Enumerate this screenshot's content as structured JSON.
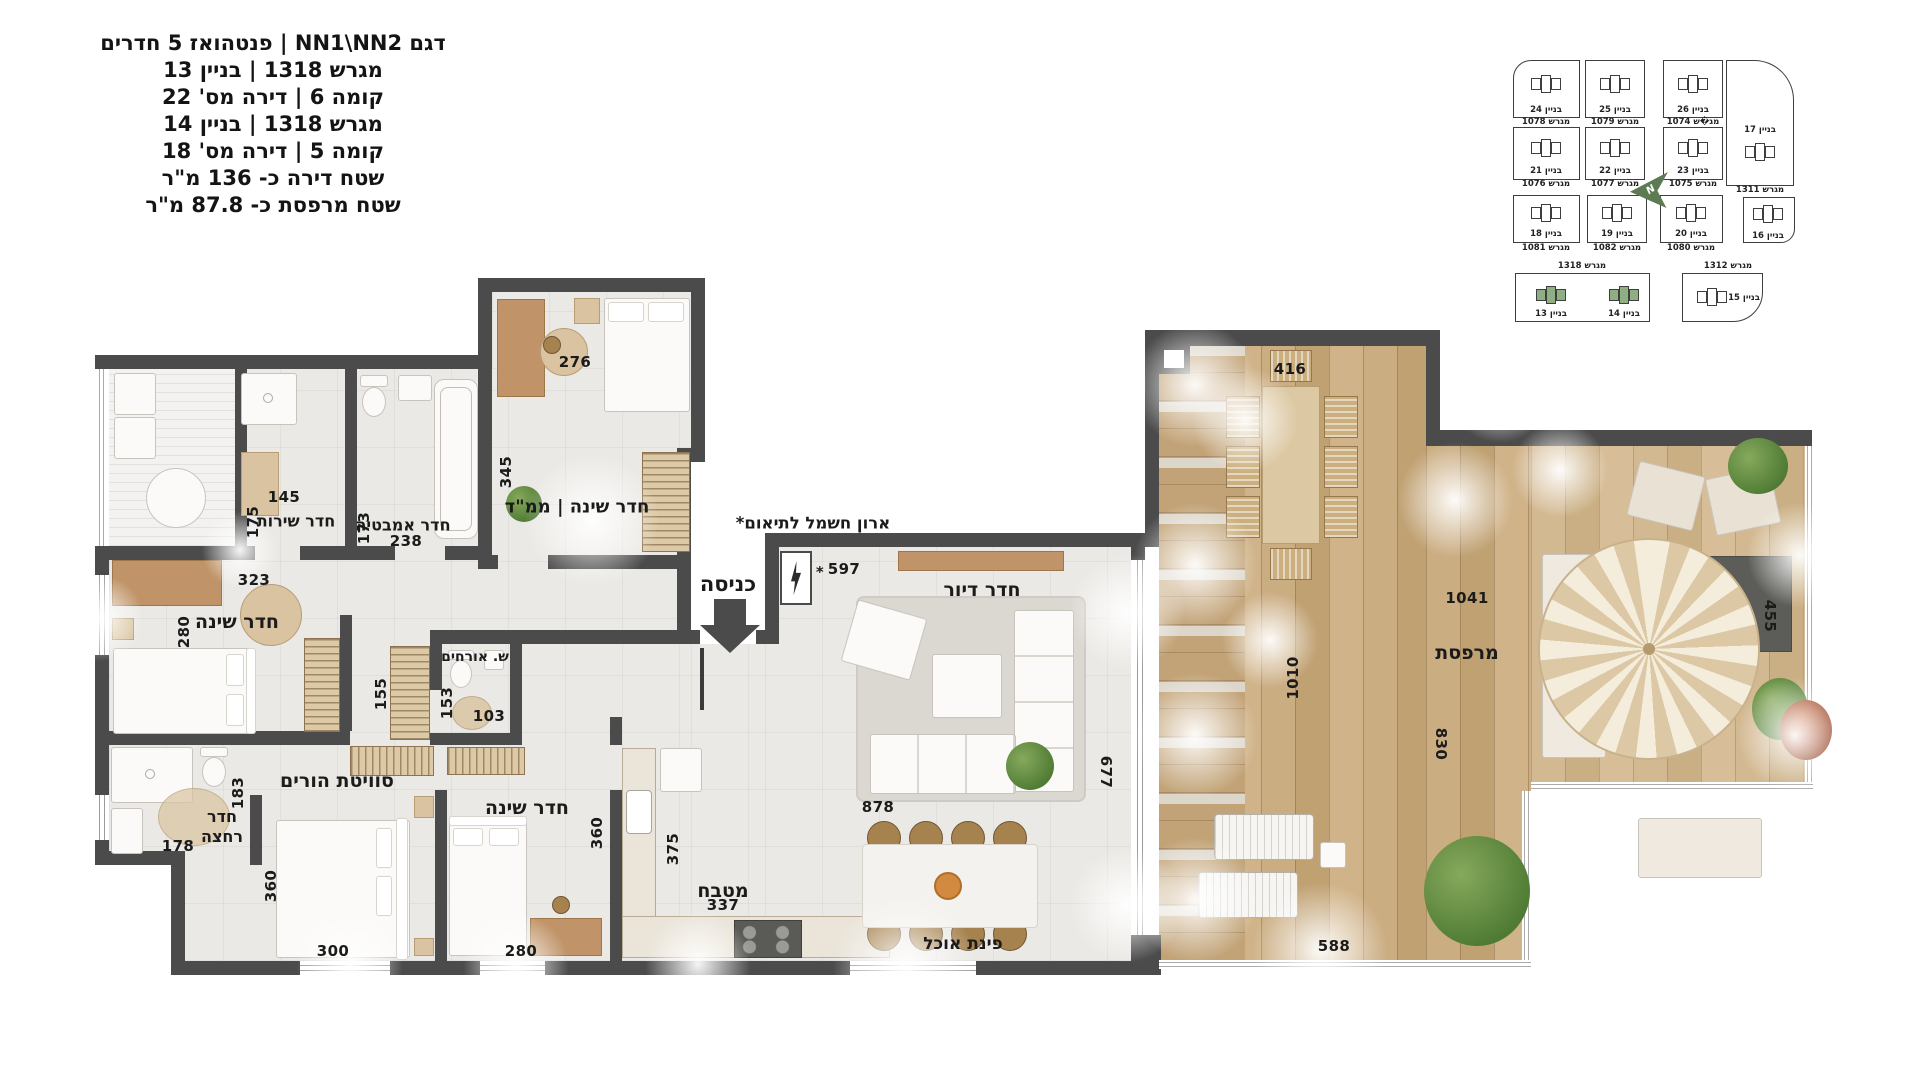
{
  "title_block": {
    "lines": [
      "דגם NN1\\NN2 | פנטהואז 5 חדרים",
      "מגרש 1318 | בניין 13",
      "קומה 6 | דירה מס' 22",
      "מגרש 1318 | בניין 14",
      "קומה 5 | דירה מס' 18",
      "שטח דירה כ-  136  מ\"ר",
      "שטח מרפסת כ-  87.8  מ\"ר"
    ]
  },
  "site_map": {
    "north_label": "N",
    "parcel_1318": "מגרש 1318",
    "parcel_1312": "מגרש 1312",
    "lots": [
      {
        "building": "בניין 24",
        "parcel": "מגרש 1078"
      },
      {
        "building": "בניין 25",
        "parcel": "מגרש 1079"
      },
      {
        "building": "בניין 26",
        "parcel": "מג�ש 1074"
      },
      {
        "building": "בניין 17",
        "parcel": "מגרש 1311"
      },
      {
        "building": "בניין 21",
        "parcel": "מגרש 1076"
      },
      {
        "building": "בניין 22",
        "parcel": "מגרש 1077"
      },
      {
        "building": "בניין 23",
        "parcel": "מגרש 1075"
      },
      {
        "building": "בניין 18",
        "parcel": "מגרש 1081"
      },
      {
        "building": "בניין 19",
        "parcel": "מגרש 1082"
      },
      {
        "building": "בניין 20",
        "parcel": "מגרש 1080"
      },
      {
        "building": "בניין 16",
        "parcel": ""
      },
      {
        "building": "בניין 13",
        "parcel": ""
      },
      {
        "building": "בניין 14",
        "parcel": ""
      },
      {
        "building": "בניין 15",
        "parcel": ""
      }
    ]
  },
  "plan": {
    "entrance": "כניסה",
    "elec_note": "ארון חשמל לתיאום*",
    "elec_dim": "597",
    "asterisk": "*",
    "rooms": {
      "mamad": {
        "label": "חדר שינה | ממ\"ד",
        "w": "276",
        "h": "345"
      },
      "service_room": {
        "label": "חדר שירות",
        "w": "145",
        "h": "175"
      },
      "bathroom": {
        "label": "חדר אמבטיה",
        "w": "238",
        "h": "173"
      },
      "bedroom_left": {
        "label": "חדר שינה",
        "w": "323",
        "h": "280"
      },
      "guest_wc": {
        "label": "ש. אורחים",
        "w": "103",
        "h": "153"
      },
      "hall_closet": {
        "h": "155"
      },
      "master": {
        "label": "סוויטת הורים",
        "w": "300",
        "h": "360"
      },
      "shower_room": {
        "label": "חדר רחצה",
        "w": "178",
        "h": "183"
      },
      "bedroom_mid": {
        "label": "חדר שינה",
        "w": "280",
        "h": "360"
      },
      "kitchen": {
        "label": "מטבח",
        "w": "337",
        "h": "375"
      },
      "living": {
        "label": "חדר דיור",
        "w": "878",
        "h": "677"
      },
      "dining": {
        "label": "פינת אוכל"
      },
      "balcony": {
        "label": "מרפסת",
        "top": "416",
        "w_main": "1041",
        "h_left": "1010",
        "h_mid": "830",
        "w_bottom": "588",
        "h_right": "455"
      }
    }
  }
}
